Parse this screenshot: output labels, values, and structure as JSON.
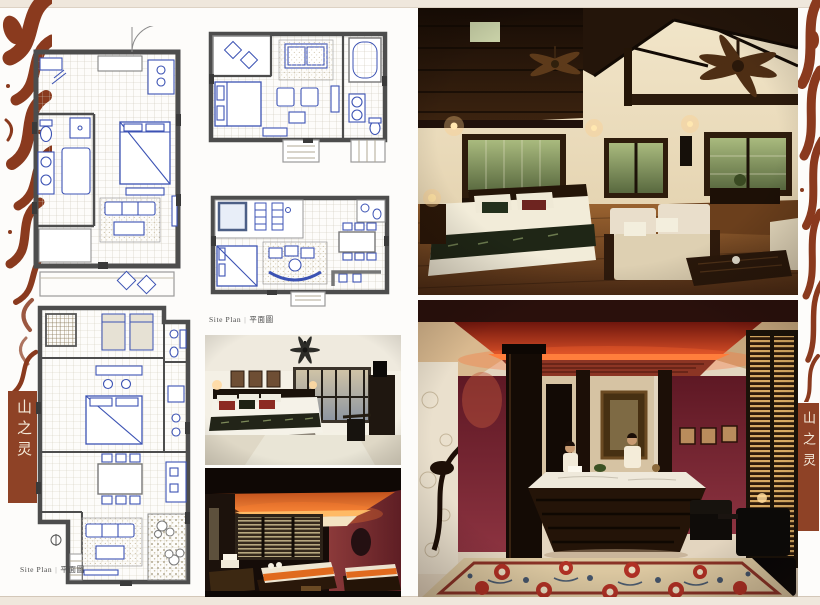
{
  "branding": {
    "title": "山之灵",
    "box_color": "#8e4226",
    "ornament_color": "#8a3a1e",
    "text_color": "#f4ead9"
  },
  "labels": {
    "site_plan_en": "Site Plan",
    "divider": "|",
    "site_plan_zh": "平面圖"
  },
  "plans": {
    "plan_a": "guestroom-floor-plan-with-balcony",
    "plan_b": "one-bedroom-villa-floor-plan-with-deck",
    "plan_c": "pool-villa-floor-plan",
    "plan_d": "two-bedroom-suite-long-floor-plan"
  },
  "photos": {
    "villa_loft": "loft-villa-bedroom-lounge-photo",
    "spa_lobby": "spa-reception-lobby-photo",
    "modern_bedroom": "modern-bedroom-photo",
    "treatment_room": "spa-treatment-room-photo"
  },
  "colors": {
    "page_margin": "#efe7dc",
    "paper": "#fdfcfa",
    "plan_wall": "#4d4d4d",
    "plan_furniture_blue": "#3c53b4",
    "photo_wood_dark": "#24150a",
    "photo_cream_wall": "#e9dcc3",
    "photo_burgundy": "#6e1f2c",
    "photo_glow_orange": "#ff7a3c",
    "carpet_base": "#dbc7a0"
  }
}
